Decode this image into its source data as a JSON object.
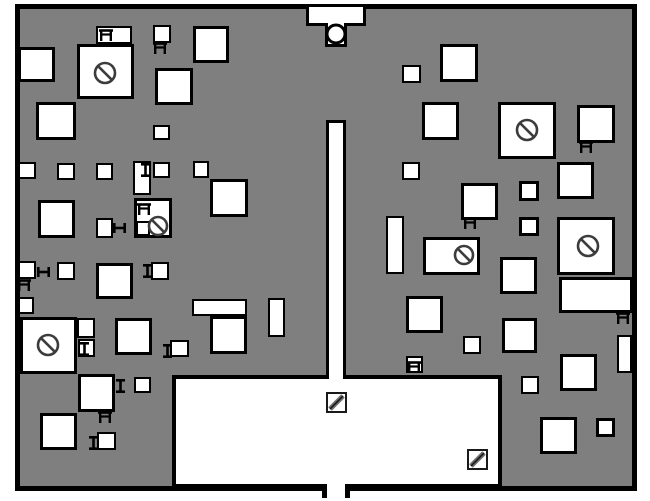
{
  "scene": {
    "kind": "floor-plan-map",
    "page_bg": "#ffffff",
    "colors": {
      "floor": "#7f7f7f",
      "wall": "#000000",
      "object_fill": "#ffffff",
      "icon_stroke": "#3c3c3c",
      "hatch_stroke": "#6e6e6e"
    },
    "map": {
      "x": 15,
      "y": 4,
      "w": 622,
      "h": 487
    },
    "entrance_top": {
      "bar": {
        "x": 306,
        "y": 4,
        "w": 60,
        "h": 22
      },
      "stem": {
        "x": 325,
        "y": 23,
        "w": 22,
        "h": 24
      },
      "circle": {
        "cx": 336,
        "cy": 34,
        "r": 9
      }
    },
    "corridor": {
      "x": 326,
      "y": 120,
      "w": 20,
      "h": 259
    },
    "room": {
      "x": 172,
      "y": 375,
      "w": 330,
      "h": 113
    },
    "bottom_door": {
      "gap": {
        "x": 327,
        "y": 484,
        "w": 18,
        "h": 13
      },
      "ticks": [
        {
          "x": 322,
          "y": 484,
          "w": 5,
          "h": 14
        },
        {
          "x": 345,
          "y": 484,
          "w": 5,
          "h": 14
        }
      ]
    },
    "boxes": [
      [
        18,
        47,
        37,
        35
      ],
      [
        96,
        26,
        36,
        18
      ],
      [
        77,
        44,
        57,
        55
      ],
      [
        153,
        25,
        18,
        18
      ],
      [
        193,
        26,
        36,
        37
      ],
      [
        155,
        68,
        38,
        37
      ],
      [
        36,
        102,
        40,
        38
      ],
      [
        153,
        125,
        17,
        15
      ],
      [
        18,
        162,
        18,
        17
      ],
      [
        57,
        163,
        18,
        17
      ],
      [
        96,
        163,
        17,
        17
      ],
      [
        133,
        161,
        18,
        34
      ],
      [
        153,
        162,
        17,
        16
      ],
      [
        193,
        161,
        16,
        17
      ],
      [
        210,
        179,
        38,
        38
      ],
      [
        134,
        198,
        38,
        40
      ],
      [
        136,
        221,
        14,
        15
      ],
      [
        38,
        200,
        37,
        38
      ],
      [
        96,
        218,
        17,
        20
      ],
      [
        18,
        261,
        18,
        18
      ],
      [
        57,
        262,
        18,
        18
      ],
      [
        96,
        263,
        37,
        36
      ],
      [
        151,
        262,
        18,
        18
      ],
      [
        18,
        297,
        16,
        17
      ],
      [
        20,
        317,
        57,
        57
      ],
      [
        77,
        318,
        18,
        20
      ],
      [
        78,
        339,
        17,
        18
      ],
      [
        115,
        318,
        37,
        37
      ],
      [
        192,
        299,
        55,
        17
      ],
      [
        210,
        316,
        37,
        38
      ],
      [
        268,
        298,
        17,
        39
      ],
      [
        170,
        340,
        19,
        17
      ],
      [
        78,
        374,
        37,
        38
      ],
      [
        134,
        377,
        17,
        16
      ],
      [
        40,
        413,
        37,
        37
      ],
      [
        97,
        432,
        19,
        18
      ],
      [
        402,
        65,
        19,
        18
      ],
      [
        440,
        44,
        38,
        38
      ],
      [
        422,
        102,
        37,
        38
      ],
      [
        498,
        102,
        58,
        57
      ],
      [
        577,
        105,
        38,
        38
      ],
      [
        402,
        162,
        18,
        18
      ],
      [
        557,
        162,
        37,
        37
      ],
      [
        461,
        183,
        37,
        37
      ],
      [
        519,
        181,
        20,
        20
      ],
      [
        519,
        217,
        20,
        19
      ],
      [
        386,
        216,
        18,
        58
      ],
      [
        423,
        237,
        57,
        38
      ],
      [
        557,
        217,
        58,
        58
      ],
      [
        559,
        277,
        74,
        36
      ],
      [
        500,
        257,
        37,
        37
      ],
      [
        406,
        296,
        37,
        37
      ],
      [
        502,
        318,
        35,
        35
      ],
      [
        617,
        335,
        15,
        38
      ],
      [
        463,
        336,
        18,
        18
      ],
      [
        521,
        376,
        18,
        18
      ],
      [
        560,
        354,
        37,
        37
      ],
      [
        540,
        417,
        37,
        37
      ],
      [
        596,
        418,
        19,
        19
      ],
      [
        406,
        356,
        17,
        17
      ]
    ],
    "icons": {
      "no_entry": [
        {
          "cx": 105,
          "cy": 73,
          "r": 10
        },
        {
          "cx": 158,
          "cy": 226,
          "r": 9
        },
        {
          "cx": 48,
          "cy": 345,
          "r": 10
        },
        {
          "cx": 527,
          "cy": 130,
          "r": 10
        },
        {
          "cx": 588,
          "cy": 246,
          "r": 10
        },
        {
          "cx": 464,
          "cy": 255,
          "r": 9
        }
      ],
      "ladder": [
        [
          99,
          29
        ],
        [
          153,
          42
        ],
        [
          137,
          203
        ],
        [
          17,
          279
        ],
        [
          98,
          411
        ],
        [
          463,
          217
        ],
        [
          579,
          141
        ],
        [
          616,
          312
        ],
        [
          407,
          361
        ]
      ],
      "ibeam_v": [
        [
          141,
          163
        ],
        [
          80,
          342
        ],
        [
          116,
          379
        ],
        [
          89,
          436
        ],
        [
          163,
          344
        ],
        [
          143,
          264
        ]
      ],
      "ibeam_h": [
        [
          37,
          267
        ],
        [
          113,
          223
        ]
      ],
      "hatch": [
        [
          327,
          393,
          19
        ],
        [
          468,
          450,
          19
        ]
      ]
    }
  }
}
